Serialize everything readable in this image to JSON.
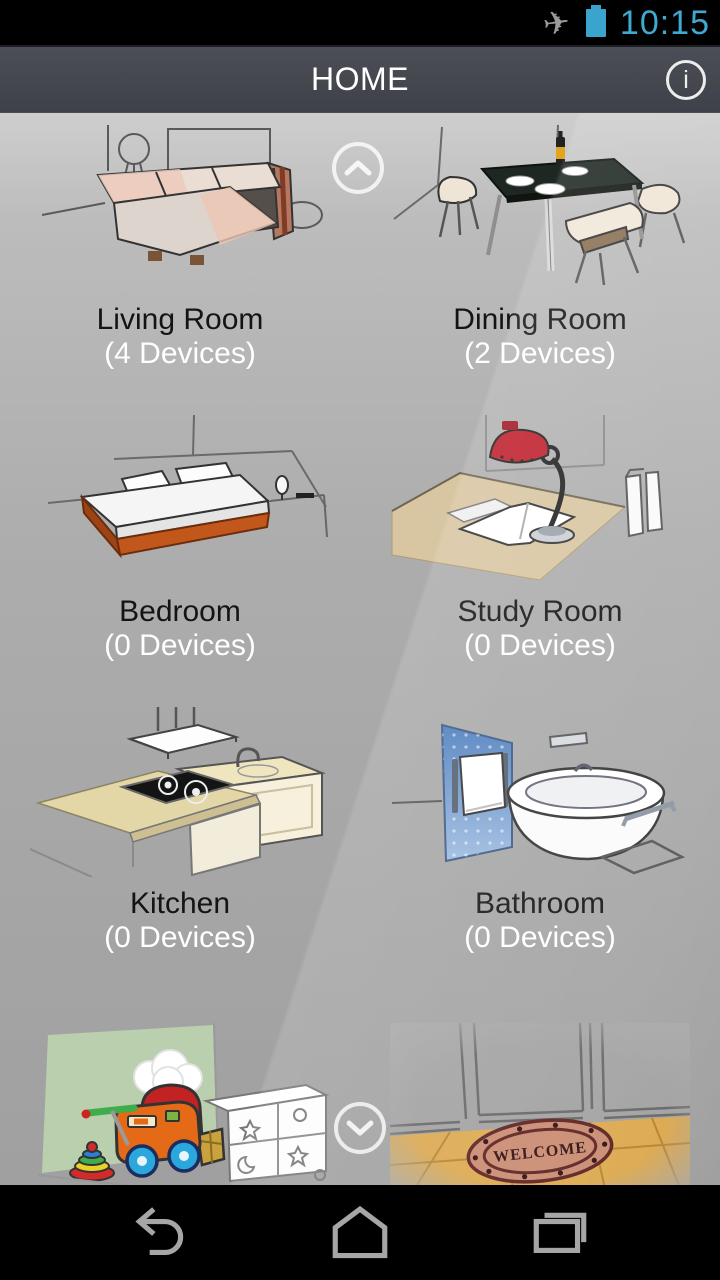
{
  "colors": {
    "accent": "#3fa9d2",
    "battery": "#3aa5cc",
    "action_bar": "#45474f",
    "content_bg_top": "#cecece",
    "content_bg_bottom": "#a0a0a0",
    "room_name_text": "#141414",
    "device_count_text": "#ffffff",
    "nav_icon": "#a6a6a6"
  },
  "status_bar": {
    "time": "10:15",
    "airplane_glyph": "✈"
  },
  "action_bar": {
    "title": "HOME",
    "info_glyph": "i"
  },
  "rooms": [
    {
      "name": "Living Room",
      "devices": "(4 Devices)",
      "illustration": "living-room"
    },
    {
      "name": "Dining Room",
      "devices": "(2 Devices)",
      "illustration": "dining-room"
    },
    {
      "name": "Bedroom",
      "devices": "(0 Devices)",
      "illustration": "bedroom"
    },
    {
      "name": "Study Room",
      "devices": "(0 Devices)",
      "illustration": "study-room"
    },
    {
      "name": "Kitchen",
      "devices": "(0 Devices)",
      "illustration": "kitchen"
    },
    {
      "name": "Bathroom",
      "devices": "(0 Devices)",
      "illustration": "bathroom"
    },
    {
      "name": "",
      "devices": "",
      "illustration": "playroom"
    },
    {
      "name": "",
      "devices": "",
      "illustration": "entrance",
      "mat_text": "WELCOME"
    }
  ],
  "scroll": {
    "up_icon": "chevron-up",
    "down_icon": "chevron-down"
  },
  "nav_bar": {
    "buttons": [
      "back",
      "home",
      "recents"
    ]
  }
}
